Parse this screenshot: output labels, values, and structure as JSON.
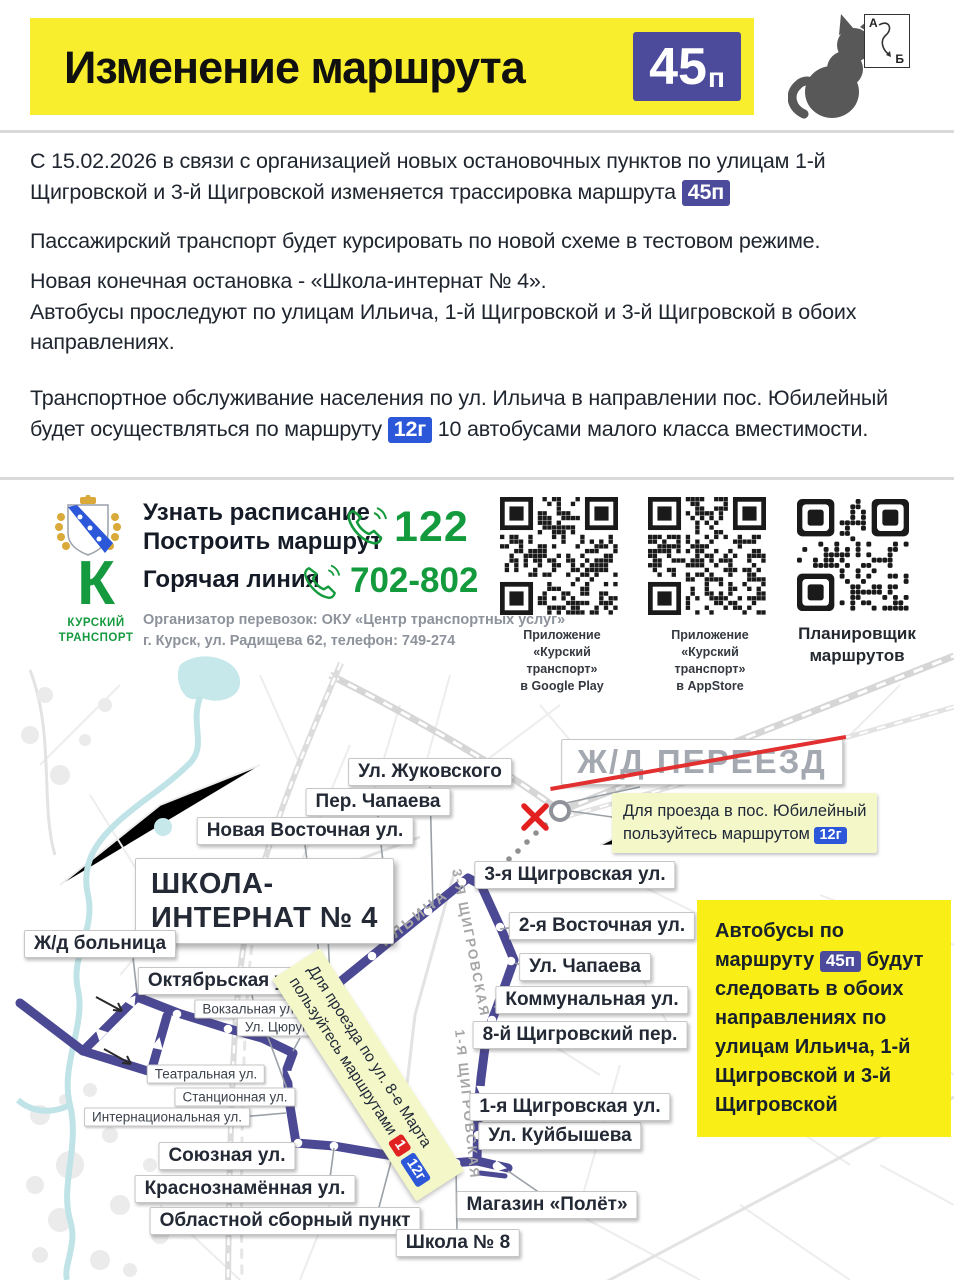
{
  "header": {
    "title": "Изменение маршрута",
    "badge_num": "45",
    "badge_suffix": "п"
  },
  "cat_card": {
    "a": "А",
    "b": "Б"
  },
  "intro": {
    "p1_pre": "С 15.02.2026 в связи с организацией новых остановочных пунктов по улицам 1-й Щигровской и 3-й Щигровской изменяется трассировка маршрута",
    "p1_badge": "45п",
    "p2": "Пассажирский транспорт будет курсировать по новой схеме в тестовом режиме.",
    "p3_line1": "Новая конечная остановка - «Школа-интернат № 4».",
    "p3_line2": "Автобусы проследуют по улицам Ильича, 1-й Щигровской и 3-й Щигровской в обоих направлениях.",
    "p4_pre": "Транспортное обслуживание населения по ул. Ильича в направлении пос. Юбилейный будет осуществляться по маршруту",
    "p4_badge": "12г",
    "p4_post": "10 автобусами малого класса вместимости."
  },
  "contacts": {
    "schedule_line1": "Узнать расписание",
    "schedule_line2": "Построить маршрут",
    "schedule_phone": "122",
    "hotline_label": "Горячая линия",
    "hotline_phone": "702-802",
    "organizer_line1": "Организатор перевозок: ОКУ «Центр транспортных услуг»",
    "organizer_line2": "г. Курск, ул. Радищева 62, телефон: 749-274",
    "brand_letter": "К",
    "brand_line1": "КУРСКИЙ",
    "brand_line2": "ТРАНСПОРТ"
  },
  "qr": {
    "q1_l1": "Приложение",
    "q1_l2": "«Курский транспорт»",
    "q1_l3": "в Google Play",
    "q2_l1": "Приложение",
    "q2_l2": "«Курский транспорт»",
    "q2_l3": "в AppStore",
    "q3_l1": "Планировщик",
    "q3_l2": "маршрутов"
  },
  "map": {
    "crossing_label": "Ж/Д ПЕРЕЕЗД",
    "crossing_note_line1": "Для проезда в пос. Юбилейный",
    "crossing_note_line2": "пользуйтесь маршрутом",
    "crossing_note_badge": "12г",
    "detour_note_line1": "Для проезда по ул. 8-е Марта",
    "detour_note_line2": "пользуйтесь маршрутами",
    "detour_badge1": "1",
    "detour_badge2": "12г",
    "terminal_line1": "ШКОЛА-",
    "terminal_line2": "ИНТЕРНАТ № 4",
    "info_pre": "Автобусы по маршруту",
    "info_badge": "45п",
    "info_post": "будут следовать в обоих направлениях по улицам Ильича, 1-й Щигровской и 3-й Щигровской",
    "street_ilyicha": "ИЛЬИЧА",
    "street_3_shchigrovskaya": "3-Я ЩИГРОВСКАЯ",
    "street_1_shchigrovskaya": "1-Я ЩИГРОВСКАЯ",
    "labels": {
      "zhukovskogo": "Ул. Жуковского",
      "per_chapaeva": "Пер. Чапаева",
      "novaya_vostochnaya": "Новая Восточная ул.",
      "zhd_bolnitsa": "Ж/д больница",
      "oktyabrskaya": "Октябрьская ул.",
      "vokzalnaya": "Вокзальная ул.",
      "tsyurupy": "Ул. Цюрупы",
      "teatralnaya": "Театральная ул.",
      "stantsionnaya": "Станционная ул.",
      "internatsionalnaya": "Интернациональная ул.",
      "soyuznaya": "Союзная ул.",
      "krasnoznamennaya": "Краснознамённая ул.",
      "oblastnoy": "Областной сборный пункт",
      "shkola8": "Школа № 8",
      "magazin_polet": "Магазин «Полёт»",
      "kuybysheva": "Ул. Куйбышева",
      "pervaya_shchigrovskaya": "1-я Щигровская ул.",
      "vosmoy_per": "8-й Щигровский пер.",
      "kommunalnaya": "Коммунальная ул.",
      "chapaeva": "Ул. Чапаева",
      "vtoraya_vostochnaya": "2-я Восточная ул.",
      "tretya_shchigrovskaya": "3-я Щигровская ул."
    }
  },
  "colors": {
    "accent_yellow": "#f8ee2e",
    "badge_indigo": "#4c4b9b",
    "badge_blue": "#2b57d8",
    "badge_red": "#e02222",
    "route_purple": "#4b4894",
    "phone_green": "#139a3c"
  }
}
